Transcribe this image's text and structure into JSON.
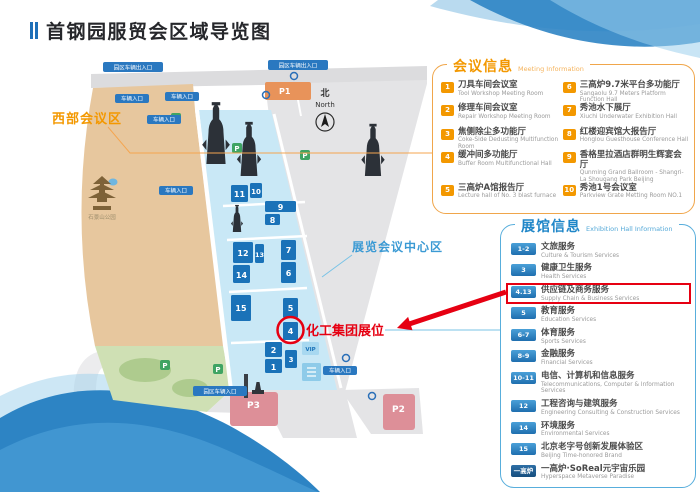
{
  "title": "首钢园服贸会区域导览图",
  "watermark": "01",
  "compass": {
    "zh": "北",
    "en": "North"
  },
  "map": {
    "area_labels": {
      "west": "西部会议区",
      "center": "展览会议中心区",
      "park": "石景山公园"
    },
    "annotation": {
      "booth": "化工集团展位"
    },
    "badges": {
      "gate_exit": "园区车辆出入口",
      "gate_main": "园区车辆入口",
      "gate_in": "车辆入口",
      "p": "P",
      "p1": "P1",
      "p2": "P2",
      "p3": "P3",
      "vip": "VIP"
    },
    "buildings": [
      "1",
      "2",
      "3",
      "4",
      "5",
      "6",
      "7",
      "8",
      "9",
      "10",
      "11",
      "12",
      "13",
      "14",
      "15"
    ],
    "colors": {
      "building_blue": "#1A72B8",
      "zone_blue": "#C9E8F6",
      "park_tan": "#E7C79E",
      "road_gray": "#E4E4E6",
      "parking_pink": "#DD8F98",
      "parking_orange": "#E8935A",
      "green": "#3FA463",
      "annotation_red": "#E60012"
    }
  },
  "meeting_panel": {
    "title_zh": "会议信息",
    "title_en": "Meeting Information",
    "accent": "#F39800",
    "items": [
      {
        "num": "1",
        "zh": "刀具车间会议室",
        "en": "Tool Workshop Meeting Room"
      },
      {
        "num": "2",
        "zh": "修理车间会议室",
        "en": "Repair Workshop Meeting Room"
      },
      {
        "num": "3",
        "zh": "焦侧除尘多功能厅",
        "en": "Coke-Side Dedusting Multifunction Room"
      },
      {
        "num": "4",
        "zh": "缓冲间多功能厅",
        "en": "Buffer Room Multifunctional Hall"
      },
      {
        "num": "5",
        "zh": "三高炉A馆报告厅",
        "en": "Lecture hall of No. 3 blast furnace"
      },
      {
        "num": "6",
        "zh": "三高炉9.7米平台多功能厅",
        "en": "Sangaolu 9.7 Meters Platform Function Hall"
      },
      {
        "num": "7",
        "zh": "秀池水下展厅",
        "en": "Xiuchi Underwater Exhibition Hall"
      },
      {
        "num": "8",
        "zh": "红楼迎宾馆大报告厅",
        "en": "Honglou Guesthouse Conference Hall"
      },
      {
        "num": "9",
        "zh": "香格里拉酒店群明生辉宴会厅",
        "en": "Qunming Grand Ballroom - Shangri-La Shougang Park Beijing"
      },
      {
        "num": "10",
        "zh": "秀池1号会议室",
        "en": "Parkview Grate Metting Room NO.1"
      }
    ]
  },
  "exhibition_panel": {
    "title_zh": "展馆信息",
    "title_en": "Exhibition Hall Information",
    "accent": "#1F86C8",
    "items": [
      {
        "num": "1-2",
        "zh": "文旅服务",
        "en": "Culture & Tourism Services"
      },
      {
        "num": "3",
        "zh": "健康卫生服务",
        "en": "Health Services"
      },
      {
        "num": "4.13",
        "zh": "供应链及商务服务",
        "en": "Supply Chain & Business Services",
        "highlight": true
      },
      {
        "num": "5",
        "zh": "教育服务",
        "en": "Education Services"
      },
      {
        "num": "6-7",
        "zh": "体育服务",
        "en": "Sports Services"
      },
      {
        "num": "8-9",
        "zh": "金融服务",
        "en": "Financial Services"
      },
      {
        "num": "10-11",
        "zh": "电信、计算机和信息服务",
        "en": "Telecommunications, Computer & Information Services"
      },
      {
        "num": "12",
        "zh": "工程咨询与建筑服务",
        "en": "Engineering Consulting & Construction Services"
      },
      {
        "num": "14",
        "zh": "环境服务",
        "en": "Environmental Services"
      },
      {
        "num": "15",
        "zh": "北京老字号创新发展体验区",
        "en": "Beijing Time-honored Brand"
      },
      {
        "num": "一高炉",
        "zh": "一高炉·SoReal元宇宙乐园",
        "en": "Hyperspace Metaverse Paradise",
        "dark": true
      }
    ]
  }
}
